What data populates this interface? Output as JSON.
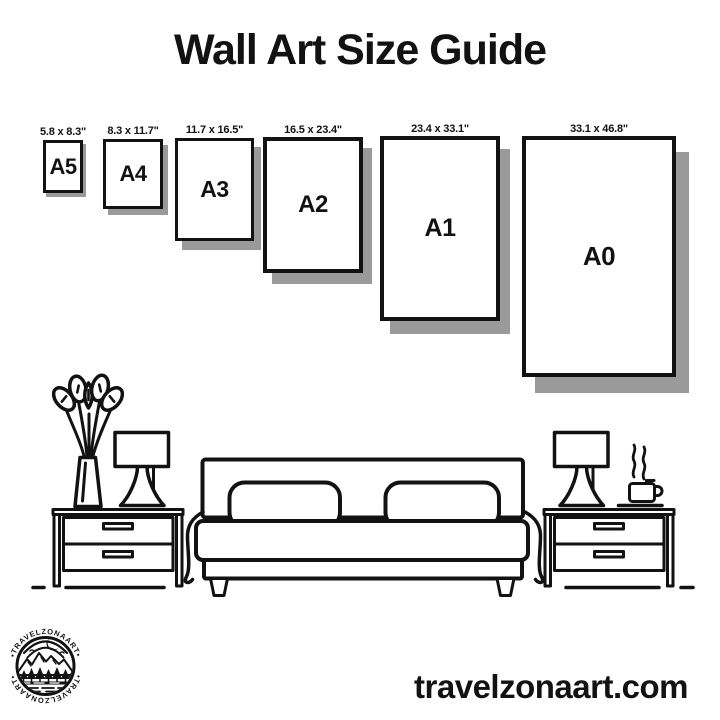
{
  "title": "Wall Art Size Guide",
  "footer": {
    "website": "travelzonaart.com"
  },
  "logo": {
    "brand": "TRAVELZONAART",
    "brand_top": "•TRAVELZONAART•",
    "brand_bottom": "•TRAVELZONAART•"
  },
  "colors": {
    "ink": "#121212",
    "shadow": "#9a9a9a",
    "background": "#ffffff"
  },
  "size_guide": {
    "units": "inches",
    "frames": [
      {
        "label": "A5",
        "dimensions": "5.8 x 8.3\"",
        "x": 43,
        "y": 140,
        "w": 40,
        "h": 53
      },
      {
        "label": "A4",
        "dimensions": "8.3 x 11.7\"",
        "x": 103,
        "y": 139,
        "w": 60,
        "h": 70
      },
      {
        "label": "A3",
        "dimensions": "11.7 x 16.5\"",
        "x": 175,
        "y": 138,
        "w": 79,
        "h": 103
      },
      {
        "label": "A2",
        "dimensions": "16.5 x 23.4\"",
        "x": 263,
        "y": 137,
        "w": 100,
        "h": 136
      },
      {
        "label": "A1",
        "dimensions": "23.4 x 33.1\"",
        "x": 380,
        "y": 136,
        "w": 120,
        "h": 185
      },
      {
        "label": "A0",
        "dimensions": "33.1 x 46.8\"",
        "x": 522,
        "y": 136,
        "w": 154,
        "h": 241
      }
    ]
  }
}
